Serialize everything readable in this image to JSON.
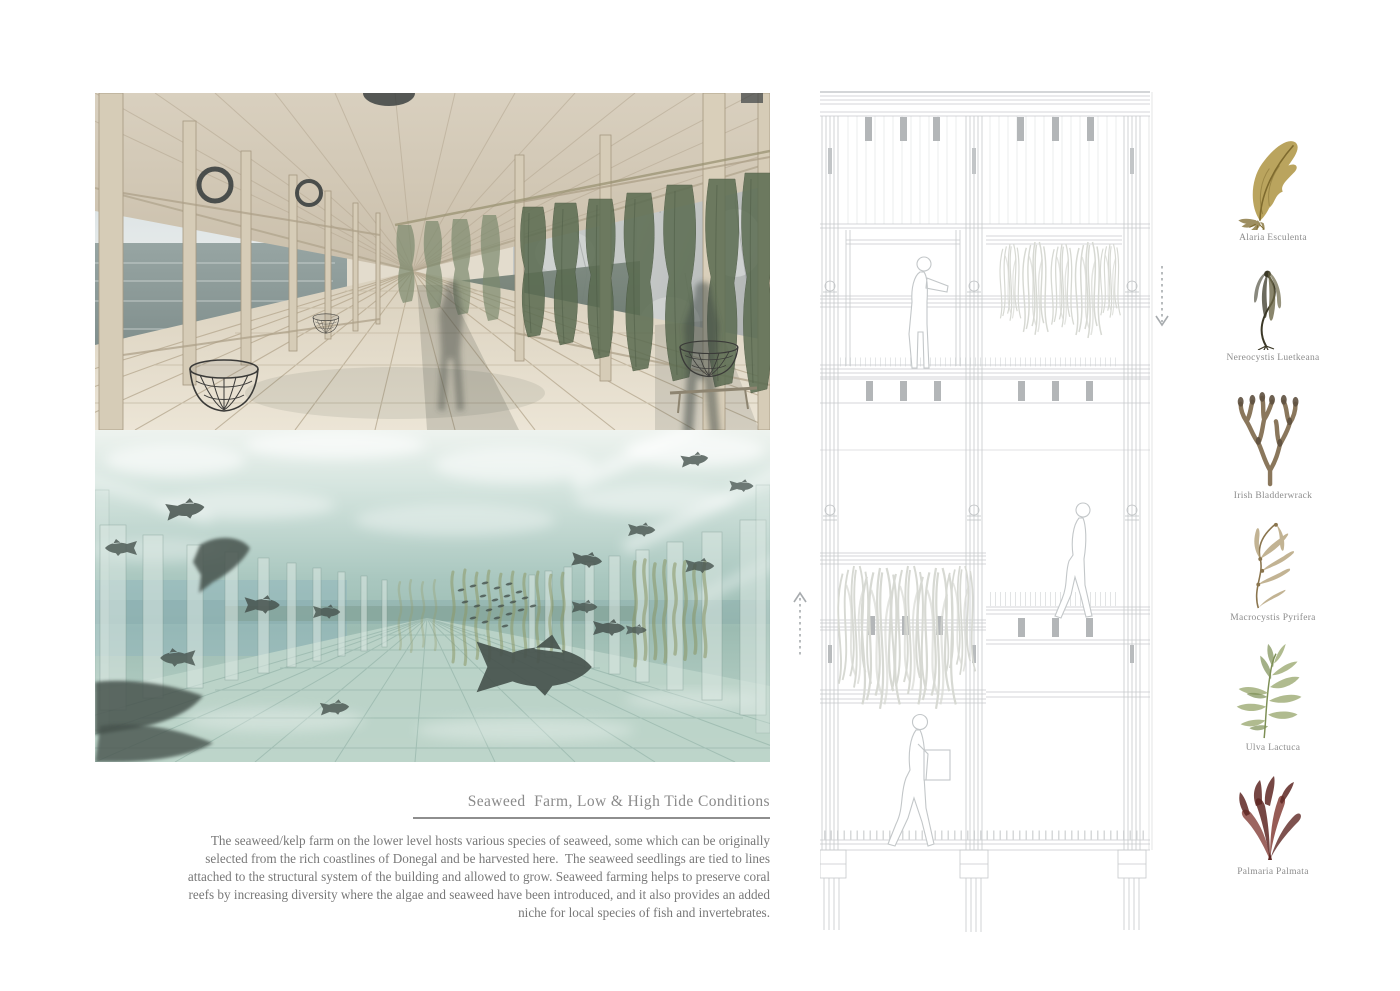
{
  "board": {
    "title": "Seaweed  Farm, Low & High Tide Conditions",
    "intro_lines": [
      "The seaweed/kelp farm on the lower level hosts various species of seaweed, some which can be originally",
      "selected from the rich coastlines of Donegal and be harvested here.  The seaweed seedlings are tied to lines",
      "attached to the structural system of the building and allowed to grow. Seaweed farming helps to preserve coral",
      "reefs by increasing diversity where the algae and seaweed have been introduced, and it also provides an added",
      "niche for local species of fish and invertebrates."
    ]
  },
  "species": [
    {
      "name": "Alaria Esculenta",
      "css_vars": "--c1:#b29a4d;--c2:#7e6a2e"
    },
    {
      "name": "Nereocystis Luetkeana",
      "css_vars": "--c1:#6b6647;--c2:#3b3827"
    },
    {
      "name": "Irish Bladderwrack",
      "css_vars": "--c1:#8a775c;--c2:#5f5140"
    },
    {
      "name": "Macrocystis Pyrifera",
      "css_vars": "--c1:#b4a179;--c2:#8a754e"
    },
    {
      "name": "Ulva Lactuca",
      "css_vars": "--c1:#a3b07c;--c2:#7d8f55"
    },
    {
      "name": "Palmaria Palmata",
      "css_vars": "--c1:#8c4a44;--c2:#5e2723"
    }
  ],
  "icons": {
    "up_arrow": "dashed-arrow-up",
    "down_arrow": "dashed-arrow-down"
  },
  "colors": {
    "css": "--title:#8a8a8a;--text:#787878;--rule:#8e8e8e;--label:#8c8c8c;--line:#c6c9cb",
    "title_text": "#8a8a8a",
    "body_text": "#787878",
    "drawing_line": "#c6c9cb",
    "render_wood": "#ddd4c2",
    "render_water": "#a7c6bf"
  }
}
